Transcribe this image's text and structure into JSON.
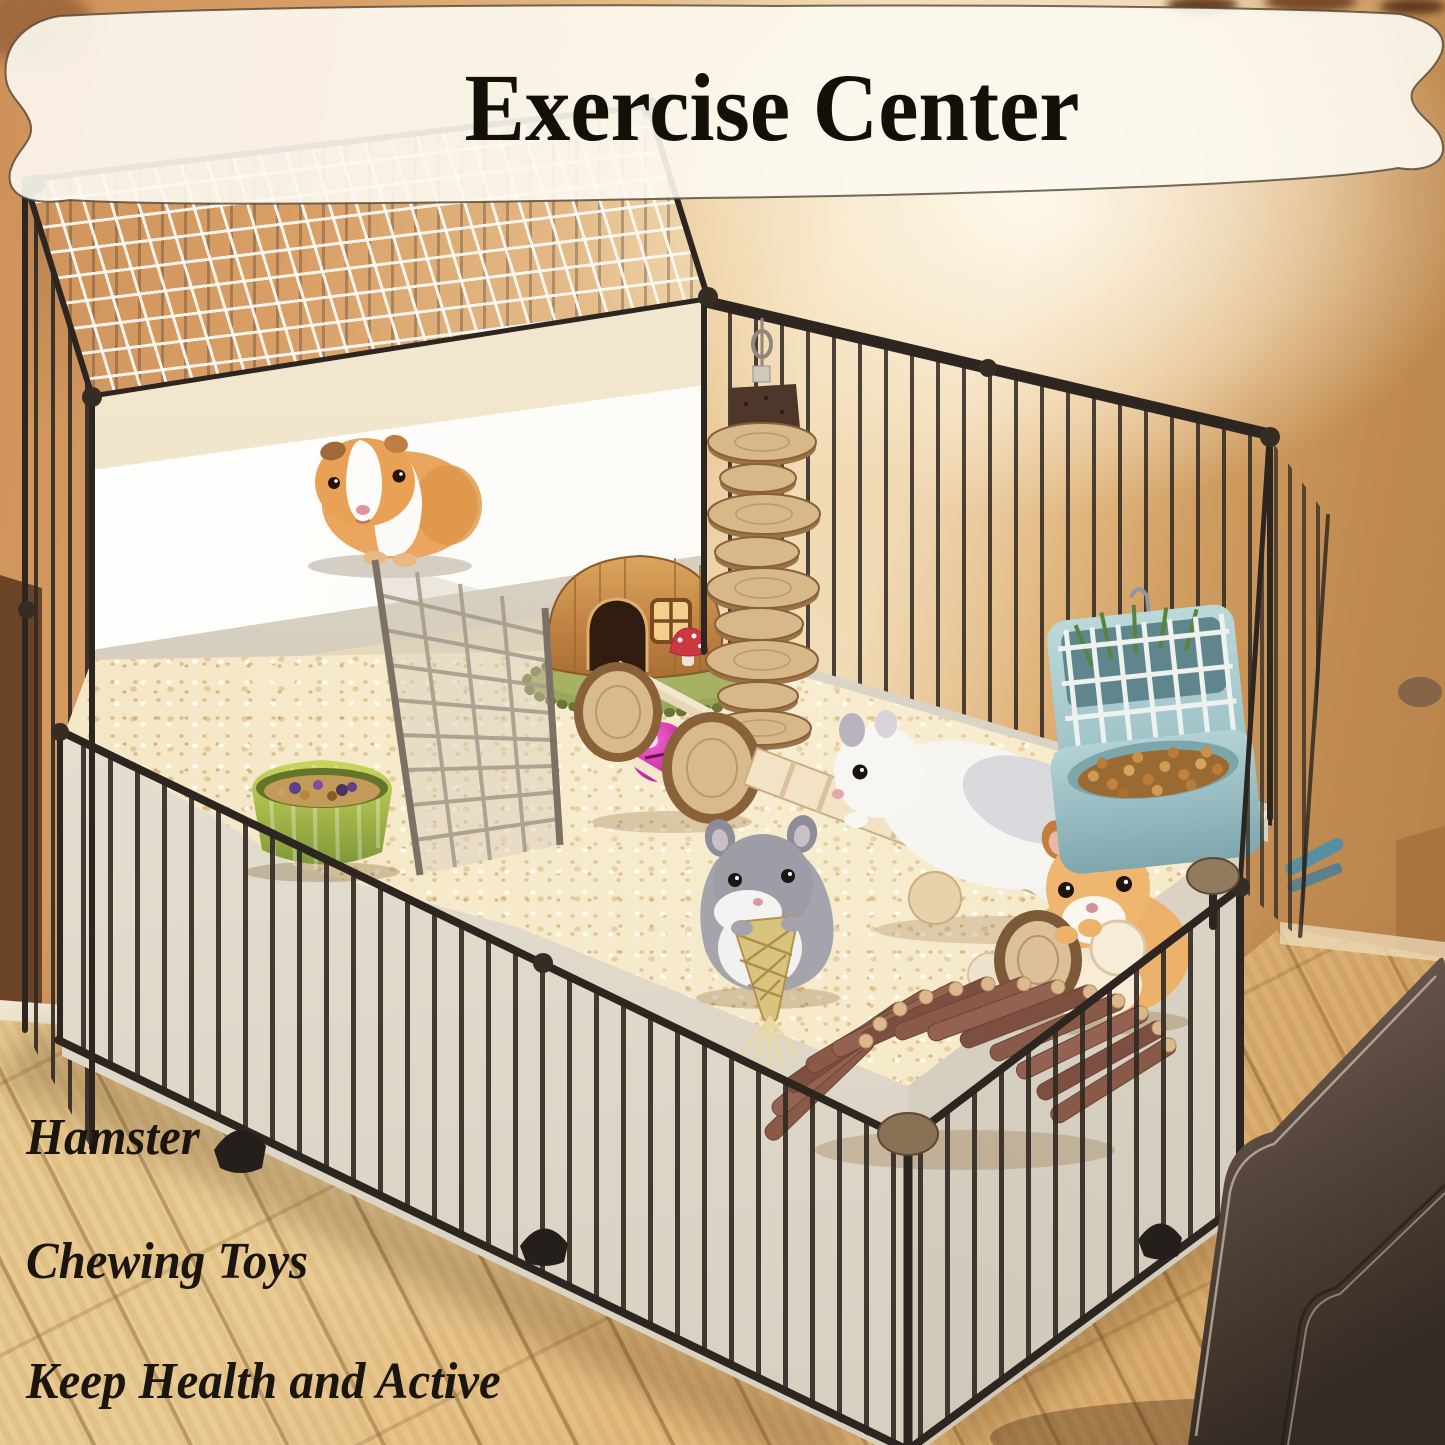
{
  "banner": {
    "title": "Exercise Center",
    "fill": "#fbf7ee",
    "border": "#6b5f49",
    "text_color": "#13100a"
  },
  "captions": {
    "color": "#1b150f",
    "lines": [
      "Hamster",
      "Chewing Toys",
      "Keep Health and Active"
    ]
  },
  "palette": {
    "wall": "#d09a62",
    "wall_glow": "#f6e8ca",
    "floor_wood": "#e0bd82",
    "cage_wire": "#3a322a",
    "bedding": "#f2e5c2",
    "liner_tub": "#f6f1e6",
    "sofa_leather": "#4e3f36",
    "hut_wood": "#c98f4e",
    "mat_green": "#9aa659",
    "feeder_blue": "#a9cdd2",
    "bell_ball_pink": "#cc2fa0",
    "bowl_green": "#a8b84a"
  },
  "scene": {
    "objects": [
      {
        "name": "banner-ribbon",
        "label": "white ribbon banner"
      },
      {
        "name": "loft-cage-tower",
        "label": "two-level wire cage tower"
      },
      {
        "name": "wire-top-mesh",
        "label": "white wire mesh roof"
      },
      {
        "name": "wire-playpen",
        "label": "black wire playpen"
      },
      {
        "name": "white-liner-tub",
        "label": "white plastic liner"
      },
      {
        "name": "paper-bedding",
        "label": "cream paper bedding"
      },
      {
        "name": "guinea-pig",
        "label": "tan and white guinea pig on platform"
      },
      {
        "name": "wire-ramp",
        "label": "wire mesh ramp"
      },
      {
        "name": "wooden-hut",
        "label": "wooden hamster hut with round door"
      },
      {
        "name": "mushroom-ornament",
        "label": "red mushroom decor"
      },
      {
        "name": "hanging-wood-disc-chew",
        "label": "hanging wooden disc chew toy"
      },
      {
        "name": "wooden-roller-chew",
        "label": "wooden roller chew toy"
      },
      {
        "name": "pink-bell-ball",
        "label": "pink bell ball"
      },
      {
        "name": "wooden-seesaw-ladder",
        "label": "wooden seesaw ladder"
      },
      {
        "name": "white-dwarf-hamster",
        "label": "white hamster climbing seesaw"
      },
      {
        "name": "grey-dwarf-hamster",
        "label": "grey hamster chewing grass toy"
      },
      {
        "name": "woven-grass-carrot-chew",
        "label": "woven grass carrot chew"
      },
      {
        "name": "golden-hamster",
        "label": "golden hamster with dumbbell"
      },
      {
        "name": "wooden-dumbbell-chew",
        "label": "wooden dumbbell chew toy"
      },
      {
        "name": "wooden-arch-bridge",
        "label": "wooden arch ladder bridge"
      },
      {
        "name": "hay-feeder-2in1",
        "label": "blue 2-in-1 hay rack feeder"
      },
      {
        "name": "food-pellets",
        "label": "food pellets in feeder"
      },
      {
        "name": "seed-treat-bowl",
        "label": "green treat bowl with seeds"
      },
      {
        "name": "water-bottle",
        "label": "blue water bottle behind bars"
      },
      {
        "name": "wood-floor",
        "label": "light wood plank floor"
      },
      {
        "name": "leather-sofa",
        "label": "dark brown leather sofa corner"
      },
      {
        "name": "room-wall",
        "label": "warm tan room wall"
      },
      {
        "name": "warm-lamp-glow",
        "label": "warm lamp glow on wall"
      }
    ]
  }
}
